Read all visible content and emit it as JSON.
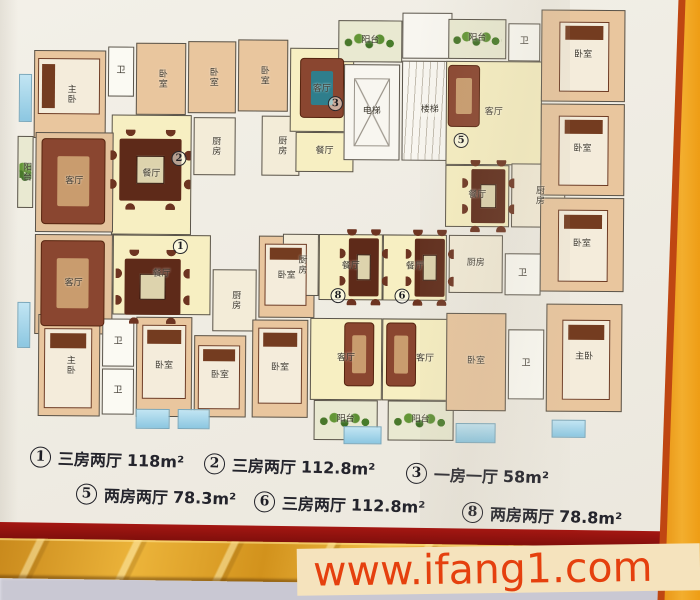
{
  "watermark": {
    "text": "www.ifang1.com"
  },
  "legend": [
    {
      "n": "1",
      "type": "三房两厅",
      "area": "118m²",
      "x": 30,
      "y": 447,
      "r": 2
    },
    {
      "n": "2",
      "type": "三房两厅",
      "area": "112.8m²",
      "x": 204,
      "y": 454,
      "r": 2
    },
    {
      "n": "3",
      "type": "一房一厅",
      "area": "58m²",
      "x": 406,
      "y": 463,
      "r": 2
    },
    {
      "n": "5",
      "type": "两房两厅",
      "area": "78.3m²",
      "x": 76,
      "y": 484,
      "r": 2
    },
    {
      "n": "6",
      "type": "三房两厅",
      "area": "112.8m²",
      "x": 254,
      "y": 492,
      "r": 2
    },
    {
      "n": "8",
      "type": "两房两厅",
      "area": "78.8m²",
      "x": 462,
      "y": 503,
      "r": 2.5
    }
  ],
  "plan": {
    "rooms": [
      {
        "name": "master-bedroom",
        "label": "主卧",
        "x": 18,
        "y": 46,
        "w": 72,
        "h": 88,
        "cls": "peach",
        "vert": true
      },
      {
        "name": "bathroom",
        "label": "卫",
        "x": 92,
        "y": 42,
        "w": 26,
        "h": 50,
        "cls": "white"
      },
      {
        "name": "bedroom",
        "label": "卧室",
        "x": 120,
        "y": 38,
        "w": 50,
        "h": 72,
        "cls": "peach",
        "vert": true
      },
      {
        "name": "bedroom",
        "label": "卧室",
        "x": 172,
        "y": 36,
        "w": 48,
        "h": 72,
        "cls": "peach",
        "vert": true
      },
      {
        "name": "dining-room",
        "label": "餐厅",
        "x": 96,
        "y": 110,
        "w": 80,
        "h": 120,
        "cls": "yellow"
      },
      {
        "name": "kitchen",
        "label": "厨房",
        "x": 178,
        "y": 112,
        "w": 42,
        "h": 58,
        "cls": "kitchen",
        "vert": true
      },
      {
        "name": "kitchen",
        "label": "厨房",
        "x": 246,
        "y": 110,
        "w": 38,
        "h": 60,
        "cls": "kitchen",
        "vert": true
      },
      {
        "name": "bedroom",
        "label": "卧室",
        "x": 222,
        "y": 34,
        "w": 50,
        "h": 72,
        "cls": "peach",
        "vert": true
      },
      {
        "name": "living-room",
        "label": "客厅",
        "x": 274,
        "y": 42,
        "w": 64,
        "h": 84,
        "cls": "yellow"
      },
      {
        "name": "dining-room",
        "label": "餐厅",
        "x": 280,
        "y": 126,
        "w": 58,
        "h": 40,
        "cls": "yellow"
      },
      {
        "name": "balcony",
        "label": "阳台",
        "x": 322,
        "y": 14,
        "w": 64,
        "h": 42,
        "cls": "balcony"
      },
      {
        "name": "elevator",
        "label": "电梯",
        "x": 328,
        "y": 58,
        "w": 56,
        "h": 96,
        "cls": "core elevator"
      },
      {
        "name": "staircase",
        "label": "楼梯",
        "x": 386,
        "y": 54,
        "w": 56,
        "h": 100,
        "cls": "stairs"
      },
      {
        "name": "stair-landing",
        "label": "",
        "x": 386,
        "y": 6,
        "w": 50,
        "h": 46,
        "cls": "core"
      },
      {
        "name": "balcony",
        "label": "阳台",
        "x": 432,
        "y": 12,
        "w": 58,
        "h": 40,
        "cls": "balcony"
      },
      {
        "name": "bathroom",
        "label": "卫",
        "x": 492,
        "y": 16,
        "w": 32,
        "h": 38,
        "cls": "white"
      },
      {
        "name": "living-room",
        "label": "客厅",
        "x": 430,
        "y": 54,
        "w": 96,
        "h": 104,
        "cls": "yellow"
      },
      {
        "name": "dining-room",
        "label": "餐厅",
        "x": 430,
        "y": 158,
        "w": 64,
        "h": 62,
        "cls": "yellow"
      },
      {
        "name": "kitchen",
        "label": "厨房",
        "x": 496,
        "y": 156,
        "w": 54,
        "h": 64,
        "cls": "kitchen",
        "vert": true
      },
      {
        "name": "bedroom",
        "label": "卧室",
        "x": 525,
        "y": 2,
        "w": 84,
        "h": 92,
        "cls": "peach"
      },
      {
        "name": "bedroom",
        "label": "卧室",
        "x": 525,
        "y": 96,
        "w": 84,
        "h": 92,
        "cls": "peach"
      },
      {
        "name": "bedroom",
        "label": "卧室",
        "x": 525,
        "y": 190,
        "w": 84,
        "h": 94,
        "cls": "peach"
      },
      {
        "name": "living-room",
        "label": "客厅",
        "x": 20,
        "y": 128,
        "w": 78,
        "h": 100,
        "cls": "tan"
      },
      {
        "name": "balcony",
        "label": "阳台",
        "x": 2,
        "y": 132,
        "w": 16,
        "h": 72,
        "cls": "balcony",
        "vert": true
      },
      {
        "name": "living-room",
        "label": "客厅",
        "x": 20,
        "y": 230,
        "w": 78,
        "h": 100,
        "cls": "tan"
      },
      {
        "name": "dining-room",
        "label": "餐厅",
        "x": 98,
        "y": 230,
        "w": 98,
        "h": 80,
        "cls": "yellow"
      },
      {
        "name": "kitchen",
        "label": "厨房",
        "x": 198,
        "y": 264,
        "w": 44,
        "h": 62,
        "cls": "kitchen",
        "vert": true
      },
      {
        "name": "bedroom",
        "label": "卧室",
        "x": 244,
        "y": 230,
        "w": 56,
        "h": 82,
        "cls": "peach"
      },
      {
        "name": "master-bedroom",
        "label": "主卧",
        "x": 24,
        "y": 310,
        "w": 62,
        "h": 102,
        "cls": "peach",
        "vert": true
      },
      {
        "name": "bathroom",
        "label": "卫",
        "x": 88,
        "y": 314,
        "w": 32,
        "h": 48,
        "cls": "white"
      },
      {
        "name": "bathroom",
        "label": "卫",
        "x": 88,
        "y": 364,
        "w": 32,
        "h": 46,
        "cls": "white"
      },
      {
        "name": "bedroom",
        "label": "卧室",
        "x": 122,
        "y": 312,
        "w": 56,
        "h": 100,
        "cls": "peach"
      },
      {
        "name": "bedroom",
        "label": "卧室",
        "x": 180,
        "y": 330,
        "w": 52,
        "h": 82,
        "cls": "peach"
      },
      {
        "name": "bedroom",
        "label": "卧室",
        "x": 238,
        "y": 314,
        "w": 56,
        "h": 98,
        "cls": "peach"
      },
      {
        "name": "kitchen",
        "label": "厨房",
        "x": 268,
        "y": 228,
        "w": 36,
        "h": 62,
        "cls": "kitchen",
        "vert": true
      },
      {
        "name": "dining-room",
        "label": "餐厅",
        "x": 304,
        "y": 228,
        "w": 64,
        "h": 66,
        "cls": "yellow"
      },
      {
        "name": "living-room",
        "label": "客厅",
        "x": 296,
        "y": 312,
        "w": 72,
        "h": 82,
        "cls": "yellow"
      },
      {
        "name": "balcony",
        "label": "阳台",
        "x": 300,
        "y": 394,
        "w": 64,
        "h": 40,
        "cls": "balcony"
      },
      {
        "name": "dining-room",
        "label": "餐厅",
        "x": 368,
        "y": 228,
        "w": 64,
        "h": 66,
        "cls": "yellow"
      },
      {
        "name": "living-room",
        "label": "客厅",
        "x": 368,
        "y": 312,
        "w": 86,
        "h": 82,
        "cls": "yellow"
      },
      {
        "name": "balcony",
        "label": "阳台",
        "x": 374,
        "y": 394,
        "w": 66,
        "h": 40,
        "cls": "balcony"
      },
      {
        "name": "kitchen",
        "label": "厨房",
        "x": 434,
        "y": 228,
        "w": 54,
        "h": 58,
        "cls": "kitchen"
      },
      {
        "name": "bathroom",
        "label": "卫",
        "x": 490,
        "y": 246,
        "w": 36,
        "h": 42,
        "cls": "white"
      },
      {
        "name": "bedroom",
        "label": "卧室",
        "x": 432,
        "y": 306,
        "w": 60,
        "h": 98,
        "cls": "peach"
      },
      {
        "name": "bathroom",
        "label": "卫",
        "x": 494,
        "y": 322,
        "w": 36,
        "h": 70,
        "cls": "white"
      },
      {
        "name": "master-bedroom",
        "label": "主卧",
        "x": 532,
        "y": 296,
        "w": 76,
        "h": 108,
        "cls": "peach"
      }
    ],
    "unit_markers": [
      {
        "n": "2",
        "x": 156,
        "y": 146
      },
      {
        "n": "3",
        "x": 312,
        "y": 90
      },
      {
        "n": "5",
        "x": 438,
        "y": 126
      },
      {
        "n": "1",
        "x": 158,
        "y": 234
      },
      {
        "n": "8",
        "x": 316,
        "y": 282
      },
      {
        "n": "6",
        "x": 380,
        "y": 282
      }
    ],
    "windows": [
      {
        "x": 3,
        "y": 70,
        "w": 13,
        "h": 48
      },
      {
        "x": 3,
        "y": 298,
        "w": 13,
        "h": 46
      },
      {
        "x": 122,
        "y": 404,
        "w": 34,
        "h": 20
      },
      {
        "x": 164,
        "y": 404,
        "w": 32,
        "h": 20
      },
      {
        "x": 330,
        "y": 420,
        "w": 38,
        "h": 18
      },
      {
        "x": 442,
        "y": 416,
        "w": 40,
        "h": 20
      },
      {
        "x": 538,
        "y": 412,
        "w": 34,
        "h": 18
      }
    ],
    "furniture": [
      {
        "t": "table",
        "x": 104,
        "y": 134,
        "w": 62,
        "h": 62
      },
      {
        "t": "table",
        "x": 110,
        "y": 254,
        "w": 56,
        "h": 56
      },
      {
        "t": "vtable",
        "x": 456,
        "y": 162,
        "w": 34,
        "h": 54
      },
      {
        "t": "vtable",
        "x": 334,
        "y": 232,
        "w": 30,
        "h": 58
      },
      {
        "t": "vtable",
        "x": 400,
        "y": 232,
        "w": 30,
        "h": 58
      },
      {
        "t": "sofa",
        "x": 26,
        "y": 134,
        "w": 64,
        "h": 86
      },
      {
        "t": "sofa",
        "x": 26,
        "y": 236,
        "w": 64,
        "h": 86
      },
      {
        "t": "bsofa",
        "x": 284,
        "y": 52,
        "w": 44,
        "h": 60
      },
      {
        "t": "vsofa",
        "x": 432,
        "y": 58,
        "w": 32,
        "h": 62
      },
      {
        "t": "vsofa",
        "x": 330,
        "y": 316,
        "w": 30,
        "h": 64
      },
      {
        "t": "vsofa",
        "x": 372,
        "y": 316,
        "w": 30,
        "h": 64
      },
      {
        "t": "bed",
        "x": 543,
        "y": 14,
        "w": 50,
        "h": 70
      },
      {
        "t": "bed",
        "x": 543,
        "y": 108,
        "w": 50,
        "h": 70
      },
      {
        "t": "bed",
        "x": 543,
        "y": 202,
        "w": 50,
        "h": 72
      },
      {
        "t": "bed",
        "x": 548,
        "y": 312,
        "w": 48,
        "h": 80
      },
      {
        "t": "bed",
        "x": 30,
        "y": 324,
        "w": 48,
        "h": 80
      },
      {
        "t": "bed",
        "x": 128,
        "y": 320,
        "w": 44,
        "h": 74
      },
      {
        "t": "bed",
        "x": 184,
        "y": 340,
        "w": 42,
        "h": 64
      },
      {
        "t": "bed",
        "x": 244,
        "y": 322,
        "w": 44,
        "h": 76
      },
      {
        "t": "bed",
        "x": 250,
        "y": 238,
        "w": 42,
        "h": 62
      },
      {
        "t": "bedh",
        "x": 22,
        "y": 54,
        "w": 62,
        "h": 56
      }
    ]
  }
}
